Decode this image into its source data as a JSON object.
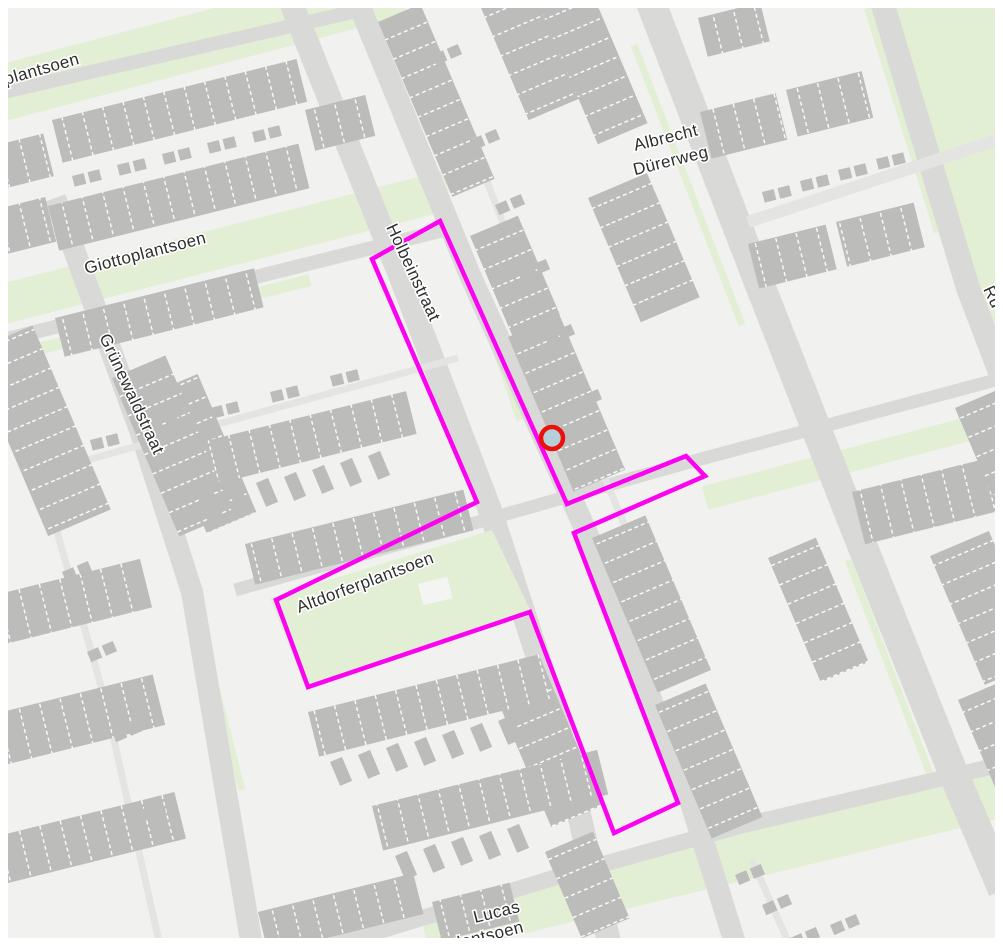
{
  "map": {
    "colors": {
      "bg": "#f1f1ef",
      "street": "#d9dad8",
      "street_minor": "#e4e5e3",
      "green": "#e2efd5",
      "building": "#bcbdbb",
      "building_divider": "#ffffff",
      "label": "#2e2e2e",
      "halo": "#ffffff",
      "overlay": "#fb02f0",
      "marker_fill": "#b6d0da",
      "marker_stroke": "#e8120b",
      "border": "#ffffff"
    },
    "labels": [
      {
        "id": "iplantsoen-partial",
        "text": "iplantsoen",
        "x": 2,
        "y": 86,
        "rotate": -16,
        "size": 17,
        "anchor": "start"
      },
      {
        "id": "giottoplantsoen",
        "text": "Giottoplantsoen",
        "x": 86,
        "y": 274,
        "rotate": -14.5,
        "size": 17,
        "anchor": "start"
      },
      {
        "id": "grunewaldstraat",
        "text": "Grünewaldstraat",
        "x": 99,
        "y": 337,
        "rotate": 65,
        "size": 17,
        "anchor": "start"
      },
      {
        "id": "holbeinstraat",
        "text": "Holbeinstraat",
        "x": 386,
        "y": 227,
        "rotate": 65,
        "size": 17,
        "anchor": "start"
      },
      {
        "id": "albrecht-durerweg-1",
        "text": "Albrecht",
        "x": 667,
        "y": 143,
        "rotate": -14,
        "size": 17,
        "anchor": "middle"
      },
      {
        "id": "albrecht-durerweg-2",
        "text": "Dürerweg",
        "x": 672,
        "y": 166,
        "rotate": -14,
        "size": 17,
        "anchor": "middle"
      },
      {
        "id": "altdorferplantsoen",
        "text": "Altdorferplantsoen",
        "x": 299,
        "y": 613,
        "rotate": -20.5,
        "size": 17,
        "anchor": "start"
      },
      {
        "id": "lucas-plantsoen-1",
        "text": "Lucas",
        "x": 475,
        "y": 923,
        "rotate": -14,
        "size": 17,
        "anchor": "start"
      },
      {
        "id": "lucas-plantsoen-2",
        "text": "hplantsoen",
        "x": 440,
        "y": 953,
        "rotate": -14,
        "size": 17,
        "anchor": "start"
      },
      {
        "id": "ru-partial",
        "text": "Ru",
        "x": 983,
        "y": 289,
        "rotate": 65,
        "size": 17,
        "anchor": "start"
      }
    ],
    "overlay": {
      "color": "#fb02f0",
      "stroke_width": 4.5,
      "polygon": [
        [
          440,
          221
        ],
        [
          567,
          504
        ],
        [
          686,
          456
        ],
        [
          705,
          476
        ],
        [
          574,
          533
        ],
        [
          678,
          803
        ],
        [
          614,
          833
        ],
        [
          530,
          612
        ],
        [
          308,
          687
        ],
        [
          276,
          600
        ],
        [
          477,
          502
        ],
        [
          372,
          259
        ]
      ]
    },
    "marker": {
      "x": 552,
      "y": 438,
      "r": 11,
      "fill": "#b6d0da",
      "stroke": "#e8120b",
      "stroke_width": 4.5
    }
  }
}
